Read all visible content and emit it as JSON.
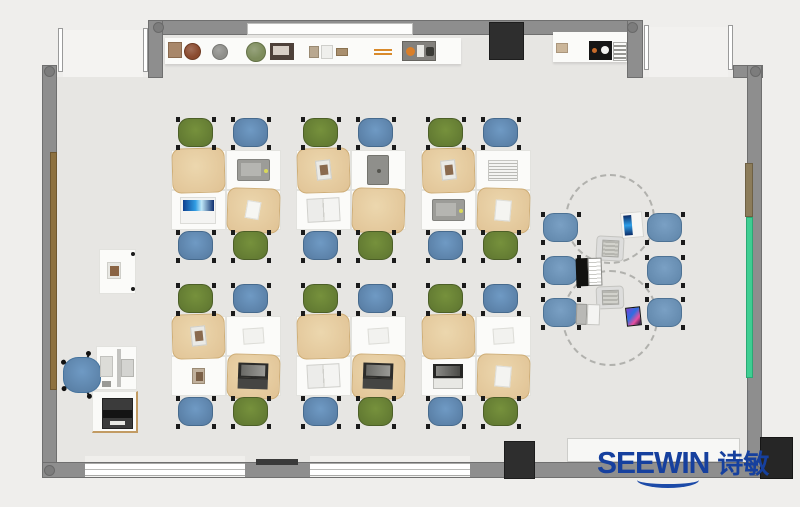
{
  "logo": {
    "text": "SEEWIN",
    "cn": "诗敏",
    "color": "#16409e"
  },
  "palette": {
    "exterior": "#efeeec",
    "floor": "#e7e6e3",
    "wall": "#8e8e8e",
    "chair_green": "#5d7430",
    "chair_blue": "#55799f",
    "collab_blue": "#5f85a9",
    "mat_tan": "#e0c294",
    "accent_green_panel": "#3fce92",
    "logo_blue": "#16409e"
  },
  "rects": [
    {
      "name": "floor-main",
      "x": 57,
      "y": 77,
      "w": 690,
      "h": 385,
      "fill": "#e7e6e3",
      "z": 1
    },
    {
      "name": "floor-top-extension",
      "x": 163,
      "y": 35,
      "w": 464,
      "h": 42,
      "fill": "#e7e6e3",
      "z": 1
    },
    {
      "name": "doorway-left-floor",
      "x": 63,
      "y": 30,
      "w": 80,
      "h": 47,
      "fill": "#f4f3f1",
      "z": 1
    },
    {
      "name": "doorway-right-floor",
      "x": 649,
      "y": 27,
      "w": 79,
      "h": 50,
      "fill": "#f2f1ef",
      "z": 1
    },
    {
      "name": "wall-top",
      "x": 148,
      "y": 20,
      "w": 495,
      "h": 15,
      "cls": "wall"
    },
    {
      "name": "wall-stub-topleft",
      "x": 148,
      "y": 20,
      "w": 15,
      "h": 58,
      "cls": "wall"
    },
    {
      "name": "wall-stub-topright",
      "x": 627,
      "y": 20,
      "w": 16,
      "h": 58,
      "cls": "wall"
    },
    {
      "name": "wall-left",
      "x": 42,
      "y": 65,
      "w": 15,
      "h": 413,
      "cls": "wall"
    },
    {
      "name": "wall-corner-topright",
      "x": 733,
      "y": 65,
      "w": 30,
      "h": 13,
      "cls": "wall"
    },
    {
      "name": "wall-right",
      "x": 747,
      "y": 65,
      "w": 15,
      "h": 413,
      "cls": "wall"
    },
    {
      "name": "wall-bottom",
      "x": 42,
      "y": 462,
      "w": 721,
      "h": 16,
      "cls": "wall"
    },
    {
      "name": "door-jamb",
      "x": 58,
      "y": 28,
      "w": 5,
      "h": 44,
      "cls": "jamb"
    },
    {
      "name": "door-jamb",
      "x": 143,
      "y": 28,
      "w": 5,
      "h": 44,
      "cls": "jamb"
    },
    {
      "name": "door-jamb",
      "x": 644,
      "y": 25,
      "w": 5,
      "h": 45,
      "cls": "jamb"
    },
    {
      "name": "door-jamb",
      "x": 728,
      "y": 25,
      "w": 5,
      "h": 45,
      "cls": "jamb"
    },
    {
      "name": "window-sill",
      "x": 85,
      "y": 456,
      "w": 160,
      "h": 6,
      "fill": "#f0efec",
      "z": 2
    },
    {
      "name": "window-sill",
      "x": 310,
      "y": 456,
      "w": 160,
      "h": 6,
      "fill": "#f0efec",
      "z": 2
    },
    {
      "name": "window-bottom-left",
      "x": 85,
      "y": 463,
      "w": 160,
      "h": 14,
      "cls": "window"
    },
    {
      "name": "window-bottom-mid",
      "x": 310,
      "y": 463,
      "w": 160,
      "h": 14,
      "cls": "window"
    },
    {
      "name": "heater-dark-strip",
      "x": 256,
      "y": 459,
      "w": 42,
      "h": 6,
      "fill": "#3a3a3a",
      "z": 4
    },
    {
      "name": "whiteboard-bottom",
      "x": 567,
      "y": 438,
      "w": 173,
      "h": 24,
      "fill": "#f7f7f5",
      "border": "#cdcdca",
      "z": 3
    },
    {
      "name": "whiteboard-top",
      "x": 247,
      "y": 23,
      "w": 166,
      "h": 12,
      "fill": "#fdfdfc",
      "border": "#bdbdbb",
      "z": 3
    },
    {
      "name": "shelf-top-long",
      "x": 165,
      "y": 38,
      "w": 296,
      "h": 26,
      "fill": "#fbfbf9",
      "cls": "shelf"
    },
    {
      "name": "shelf-top-right",
      "x": 553,
      "y": 32,
      "w": 74,
      "h": 30,
      "fill": "#fbfbf9",
      "cls": "shelf"
    },
    {
      "name": "cabinet-black-top",
      "x": 489,
      "y": 22,
      "w": 35,
      "h": 38,
      "fill": "#2e2e2e",
      "border": "#1d1d1d",
      "z": 5
    },
    {
      "name": "cabinet-black-bottom",
      "x": 504,
      "y": 441,
      "w": 31,
      "h": 38,
      "fill": "#2e2e2e",
      "border": "#1d1d1d",
      "z": 5
    },
    {
      "name": "cabinet-black-corner",
      "x": 760,
      "y": 437,
      "w": 33,
      "h": 42,
      "fill": "#262626",
      "border": "#161616",
      "z": 5
    },
    {
      "name": "wood-door-panel-left",
      "x": 50,
      "y": 152,
      "w": 7,
      "h": 238,
      "fill": "#8d7140",
      "border": "#6e5730",
      "z": 3
    },
    {
      "name": "panel-brown-right",
      "x": 745,
      "y": 163,
      "w": 8,
      "h": 54,
      "fill": "#8c7c5a",
      "border": "#6e6044",
      "z": 3
    },
    {
      "name": "panel-green-right",
      "x": 746,
      "y": 217,
      "w": 7,
      "h": 161,
      "fill": "#3fce92",
      "border": "#2aa974",
      "z": 3
    }
  ],
  "caps": [
    [
      158,
      27
    ],
    [
      632,
      27
    ],
    [
      49,
      71
    ],
    [
      755,
      71
    ],
    [
      49,
      470
    ],
    [
      755,
      470
    ]
  ],
  "shelf_items": [
    {
      "t": "rect",
      "name": "deco-box",
      "x": 168,
      "y": 42,
      "w": 14,
      "h": 16,
      "fill": "#a8876a",
      "border": "#8a6a4e"
    },
    {
      "t": "circle",
      "name": "deco-pot",
      "x": 184,
      "y": 43,
      "w": 17,
      "h": 17,
      "fill": "#8a4a2e",
      "border": "#6e3a22"
    },
    {
      "t": "circle",
      "name": "deco-sphere",
      "x": 212,
      "y": 44,
      "w": 16,
      "h": 16,
      "fill": "#8e8e8a",
      "border": "#767672"
    },
    {
      "t": "circle",
      "name": "deco-plant",
      "x": 246,
      "y": 42,
      "w": 20,
      "h": 20,
      "fill": "#7d8c5c",
      "border": "#647247"
    },
    {
      "t": "frame",
      "name": "photo-frame",
      "x": 270,
      "y": 43,
      "w": 24,
      "h": 17,
      "fill": "#4e413a",
      "inner": "#d8cfc6"
    },
    {
      "t": "rect",
      "name": "deco-small",
      "x": 309,
      "y": 46,
      "w": 10,
      "h": 12,
      "fill": "#b9a890",
      "border": "#9a8a72"
    },
    {
      "t": "rect",
      "name": "deco-card",
      "x": 321,
      "y": 45,
      "w": 12,
      "h": 14,
      "fill": "#efefec",
      "border": "#cfcfcb"
    },
    {
      "t": "rect",
      "name": "deco-small-2",
      "x": 336,
      "y": 48,
      "w": 12,
      "h": 8,
      "fill": "#a98f6e",
      "border": "#8a7250"
    },
    {
      "t": "pencil",
      "name": "pencil-pair",
      "x": 374,
      "y": 49,
      "w": 18,
      "h": 6,
      "fill": "#d98a2b"
    },
    {
      "t": "tray",
      "name": "trinket-tray",
      "x": 402,
      "y": 41,
      "w": 34,
      "h": 20,
      "fill": "#83817d"
    },
    {
      "t": "rect",
      "name": "deco-beige",
      "x": 556,
      "y": 43,
      "w": 12,
      "h": 10,
      "fill": "#cbb69a",
      "border": "#ab967c"
    },
    {
      "t": "cam",
      "name": "speaker-black",
      "x": 589,
      "y": 41,
      "w": 23,
      "h": 19,
      "fill": "#161616"
    },
    {
      "t": "ladder",
      "name": "rack-striped",
      "x": 613,
      "y": 42,
      "w": 14,
      "h": 19
    }
  ],
  "clusters": {
    "chair_w": 41,
    "chair_h": 33,
    "desk_w": 55,
    "desk_h": 40,
    "chair_top": [
      "green",
      "blue"
    ],
    "chair_bottom": [
      "blue",
      "green"
    ],
    "positions": [
      {
        "x": 171,
        "y": 117
      },
      {
        "x": 296,
        "y": 117
      },
      {
        "x": 421,
        "y": 117
      },
      {
        "x": 171,
        "y": 283
      },
      {
        "x": 296,
        "y": 283
      },
      {
        "x": 421,
        "y": 283
      }
    ],
    "desk_items": [
      [
        "mat",
        "device-gray",
        "tablet-blue",
        "mat-note"
      ],
      [
        "mat-book",
        "pad-dark",
        "book-open",
        "mat"
      ],
      [
        "mat-book",
        "notebook",
        "device-gray",
        "mat-paper"
      ],
      [
        "mat-book",
        "paper",
        "item-small",
        "mat-laptop"
      ],
      [
        "mat",
        "paper",
        "book-open",
        "mat-laptop"
      ],
      [
        "mat",
        "paper",
        "laptop-dark",
        "mat-paper"
      ]
    ]
  },
  "collab": {
    "circles": [
      {
        "cx": 610,
        "cy": 219,
        "r": 45
      },
      {
        "cx": 610,
        "cy": 318,
        "r": 48
      }
    ],
    "chairs": [
      {
        "x": 541,
        "y": 212
      },
      {
        "x": 645,
        "y": 212
      },
      {
        "x": 541,
        "y": 255
      },
      {
        "x": 645,
        "y": 255
      },
      {
        "x": 541,
        "y": 297
      },
      {
        "x": 645,
        "y": 297
      }
    ],
    "devices": [
      {
        "type": "tablet-white",
        "x": 621,
        "y": 212,
        "w": 22,
        "h": 26,
        "rot": -5
      },
      {
        "type": "pad-gray",
        "x": 596,
        "y": 236,
        "w": 28,
        "h": 25,
        "rot": 3
      },
      {
        "type": "laptop-black",
        "x": 576,
        "y": 258,
        "w": 27,
        "h": 28,
        "rot": -2
      },
      {
        "type": "pad-gray",
        "x": 596,
        "y": 286,
        "w": 28,
        "h": 23,
        "rot": -2
      },
      {
        "type": "laptop-silver",
        "x": 576,
        "y": 304,
        "w": 25,
        "h": 21,
        "rot": 2
      },
      {
        "type": "phone",
        "x": 626,
        "y": 307,
        "w": 15,
        "h": 19,
        "rot": -6
      }
    ]
  },
  "teacher": {
    "side_table": {
      "x": 99,
      "y": 249,
      "w": 37,
      "h": 45
    },
    "side_item": {
      "x": 107,
      "y": 262,
      "w": 14,
      "h": 17
    },
    "desk": {
      "x": 96,
      "y": 346,
      "w": 41,
      "h": 44
    },
    "papers": {
      "x": 100,
      "y": 356,
      "w": 13,
      "h": 21
    },
    "small_item": {
      "x": 102,
      "y": 381,
      "w": 9,
      "h": 6
    },
    "monitor_bar": {
      "x": 117,
      "y": 349,
      "w": 4,
      "h": 38
    },
    "monitor_screen": {
      "x": 121,
      "y": 359,
      "w": 13,
      "h": 18
    },
    "chair": {
      "cx": 82,
      "cy": 375,
      "w": 38,
      "h": 36
    },
    "stand": {
      "x": 92,
      "y": 391,
      "w": 46,
      "h": 42
    },
    "printer": {
      "x": 102,
      "y": 398,
      "w": 31,
      "h": 31
    }
  }
}
